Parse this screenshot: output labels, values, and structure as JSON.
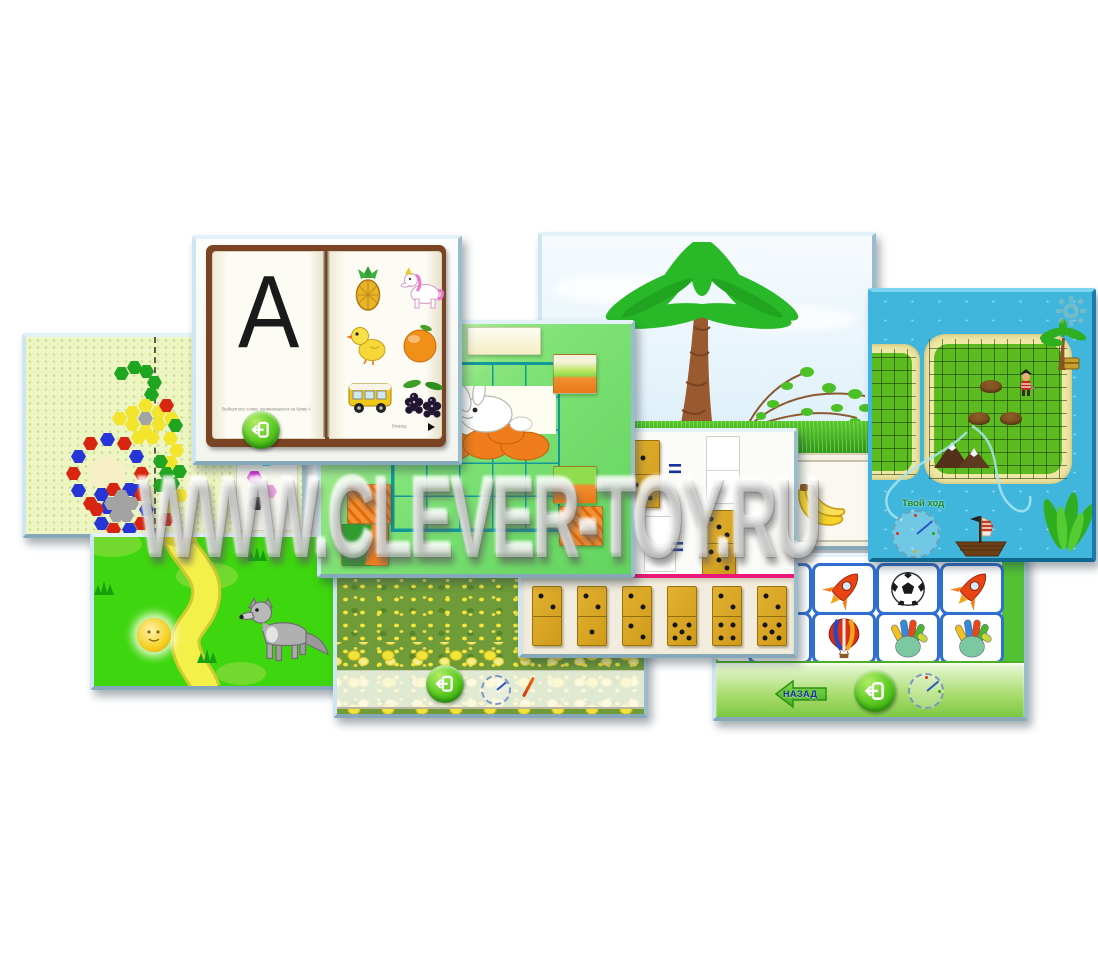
{
  "watermark": {
    "text": "WWW.CLEVER-TOY.RU"
  },
  "book": {
    "letter": "А",
    "caption": "Выбери все слова, начинающиеся на букву А",
    "forward_label": "Вперед",
    "images": [
      "pineapple",
      "unicorn",
      "chick",
      "orange",
      "bus",
      "blackberry"
    ]
  },
  "mosaic": {
    "hexes": [
      [
        88,
        30,
        "g"
      ],
      [
        101,
        24,
        "g"
      ],
      [
        113,
        28,
        "g"
      ],
      [
        121,
        39,
        "g"
      ],
      [
        118,
        51,
        "g"
      ],
      [
        112,
        75,
        "gy"
      ],
      [
        99,
        69,
        "y"
      ],
      [
        112,
        62,
        "y"
      ],
      [
        125,
        69,
        "y"
      ],
      [
        99,
        81,
        "y"
      ],
      [
        112,
        88,
        "y"
      ],
      [
        125,
        81,
        "y"
      ],
      [
        86,
        75,
        "y"
      ],
      [
        138,
        75,
        "y"
      ],
      [
        105,
        94,
        "y"
      ],
      [
        119,
        94,
        "y"
      ],
      [
        133,
        62,
        "r"
      ],
      [
        142,
        82,
        "g"
      ],
      [
        137,
        95,
        "y"
      ],
      [
        143,
        107,
        "y"
      ],
      [
        137,
        119,
        "y"
      ],
      [
        146,
        128,
        "g"
      ],
      [
        139,
        140,
        "g"
      ],
      [
        147,
        152,
        "y"
      ],
      [
        139,
        164,
        "y"
      ],
      [
        133,
        176,
        "r"
      ],
      [
        127,
        118,
        "g"
      ],
      [
        133,
        130,
        "g"
      ],
      [
        127,
        142,
        "g"
      ],
      [
        108,
        130,
        "r"
      ],
      [
        103,
        147,
        "b"
      ],
      [
        91,
        160,
        "r"
      ],
      [
        74,
        164,
        "b"
      ],
      [
        57,
        160,
        "r"
      ],
      [
        45,
        147,
        "b"
      ],
      [
        40,
        130,
        "r"
      ],
      [
        45,
        113,
        "b"
      ],
      [
        57,
        100,
        "r"
      ],
      [
        74,
        96,
        "b"
      ],
      [
        91,
        100,
        "r"
      ],
      [
        103,
        113,
        "b"
      ],
      [
        74,
        130,
        "c"
      ],
      [
        62,
        124,
        "c"
      ],
      [
        86,
        124,
        "c"
      ],
      [
        62,
        136,
        "c"
      ],
      [
        86,
        136,
        "c"
      ],
      [
        74,
        118,
        "c"
      ],
      [
        74,
        142,
        "c"
      ],
      [
        113,
        166,
        "b"
      ],
      [
        108,
        180,
        "r"
      ],
      [
        96,
        186,
        "b"
      ],
      [
        80,
        186,
        "r"
      ],
      [
        68,
        180,
        "b"
      ],
      [
        63,
        166,
        "r"
      ],
      [
        68,
        151,
        "b"
      ],
      [
        80,
        146,
        "r"
      ],
      [
        96,
        146,
        "b"
      ],
      [
        108,
        151,
        "r"
      ],
      [
        88,
        166,
        "gy"
      ],
      [
        78,
        160,
        "gy"
      ],
      [
        98,
        160,
        "gy"
      ],
      [
        88,
        153,
        "gy"
      ],
      [
        83,
        172,
        "gy"
      ],
      [
        93,
        172,
        "gy"
      ],
      [
        233,
        116,
        "cy"
      ],
      [
        221,
        134,
        "m"
      ],
      [
        236,
        148,
        "p"
      ],
      [
        223,
        160,
        "k"
      ]
    ]
  },
  "puzzle": {
    "thumbs": [
      {
        "x": 10,
        "y": 3,
        "w": 44,
        "h": 36,
        "kind": "yellow"
      },
      {
        "x": 60,
        "y": 3,
        "w": 44,
        "h": 36,
        "kind": "yellow"
      },
      {
        "x": 146,
        "y": 3,
        "w": 72,
        "h": 26,
        "kind": "sky"
      },
      {
        "x": 232,
        "y": 30,
        "w": 42,
        "h": 38,
        "kind": "hill"
      },
      {
        "x": 232,
        "y": 142,
        "w": 42,
        "h": 36,
        "kind": "grassorange"
      },
      {
        "x": 238,
        "y": 182,
        "w": 42,
        "h": 38,
        "kind": "carrot"
      },
      {
        "x": 26,
        "y": 160,
        "w": 42,
        "h": 38,
        "kind": "carrot"
      },
      {
        "x": 20,
        "y": 200,
        "w": 46,
        "h": 40,
        "kind": "leaforange"
      }
    ]
  },
  "pirate": {
    "turn_label": "Твой ход"
  },
  "domino": {
    "equations": [
      {
        "left": [
          1,
          2
        ],
        "right": null
      },
      {
        "left": null,
        "right": [
          3,
          3
        ]
      }
    ],
    "tray": [
      [
        2,
        0
      ],
      [
        2,
        1
      ],
      [
        2,
        2
      ],
      [
        0,
        5
      ],
      [
        2,
        4
      ],
      [
        2,
        5
      ]
    ]
  },
  "memory": {
    "back_label": "НАЗАД",
    "grid": [
      [
        "beachball",
        "rocket",
        "soccer",
        "rocket"
      ],
      [
        "soccer",
        "balloon",
        "hand",
        "hand"
      ]
    ]
  }
}
